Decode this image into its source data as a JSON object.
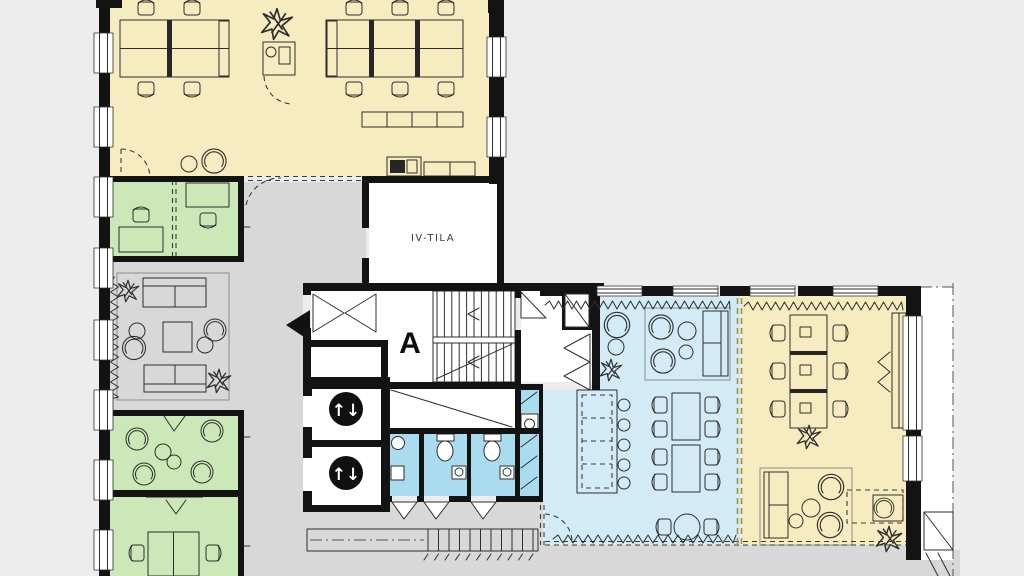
{
  "labels": {
    "ventilation_room": "IV-TILA",
    "stair_core": "A",
    "elevator_arrows": "↑↓"
  },
  "colors": {
    "background": "#ededee",
    "floor_corridor": "#d8d8d8",
    "floor_office_yellow": "#f6ecc0",
    "floor_meeting_green": "#cde8b8",
    "floor_cafe_blue": "#d2ebf6",
    "floor_wet_blue": "#a9dcee",
    "floor_white": "#ffffff",
    "wall": "#131313",
    "furniture_line": "#2e2e2e"
  },
  "areas": [
    {
      "id": "open-office-north",
      "color_key": "floor_office_yellow"
    },
    {
      "id": "meeting-room-upper-green",
      "color_key": "floor_meeting_green"
    },
    {
      "id": "lounge-corridor",
      "color_key": "floor_corridor"
    },
    {
      "id": "meeting-room-green-b",
      "color_key": "floor_meeting_green"
    },
    {
      "id": "meeting-room-green-c",
      "color_key": "floor_meeting_green"
    },
    {
      "id": "ventilation-room",
      "color_key": "floor_white",
      "label": "IV-TILA"
    },
    {
      "id": "stair-core",
      "color_key": "floor_white",
      "label": "A"
    },
    {
      "id": "elevator-shafts",
      "color_key": "floor_white",
      "label": "↑↓"
    },
    {
      "id": "wc-block",
      "color_key": "floor_wet_blue"
    },
    {
      "id": "cafe-lounge",
      "color_key": "floor_cafe_blue"
    },
    {
      "id": "open-office-east",
      "color_key": "floor_office_yellow"
    }
  ]
}
